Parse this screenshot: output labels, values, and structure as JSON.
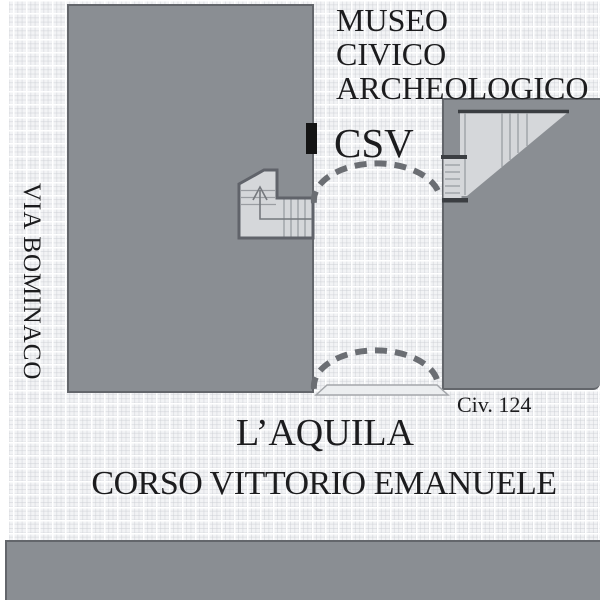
{
  "map": {
    "title": "Location plan of CSV office at Museo Civico Archeologico, L'Aquila",
    "labels": {
      "museum_line1": "MUSEO",
      "museum_line2": "CIVICO",
      "museum_line3": "ARCHEOLOGICO",
      "csv": "CSV",
      "street_left": "VIA BOMINACO",
      "street_bottom": "CORSO VITTORIO EMANUELE",
      "city": "L’AQUILA",
      "civic_number": "Civ. 124"
    },
    "colors": {
      "building": "#8a8e93",
      "building_edge": "#63666b",
      "street_bg": "#f2f3f5",
      "grid_major": "#ffffff",
      "white_margin": "#ffffff",
      "stair_fill": "#d5d7da",
      "stair_line": "#9a9da2",
      "stair_outline": "#60636a",
      "stair_dark": "#3b3e42",
      "walk_line": "#75787d",
      "dash_arc": "#6b6e73",
      "door_marker": "#141414",
      "threshold_fill": "#eceef0",
      "threshold_edge": "#a3a6aa",
      "text": "#1c1c1e"
    }
  }
}
